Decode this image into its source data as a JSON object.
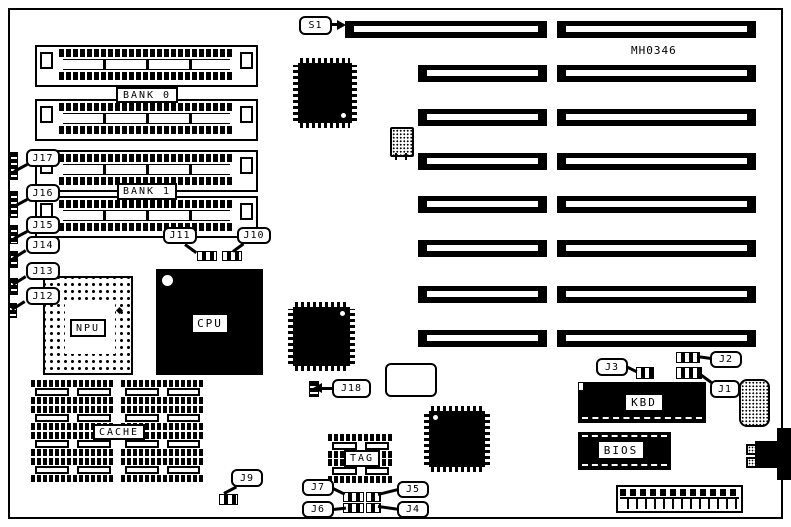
{
  "diagram": {
    "part_number": "MH0346",
    "switch_labels": {
      "s1": "S1"
    },
    "jumper_labels": {
      "j1": "J1",
      "j2": "J2",
      "j3": "J3",
      "j4": "J4",
      "j5": "J5",
      "j6": "J6",
      "j7": "J7",
      "j9": "J9",
      "j10": "J10",
      "j11": "J11",
      "j12": "J12",
      "j13": "J13",
      "j14": "J14",
      "j15": "J15",
      "j16": "J16",
      "j17": "J17",
      "j18": "J18"
    },
    "memory": {
      "bank0": "BANK 0",
      "bank1": "BANK 1"
    },
    "chips": {
      "npu": "NPU",
      "cpu": "CPU",
      "cache": "CACHE",
      "tag": "TAG",
      "kbd": "KBD",
      "bios": "BIOS"
    }
  }
}
